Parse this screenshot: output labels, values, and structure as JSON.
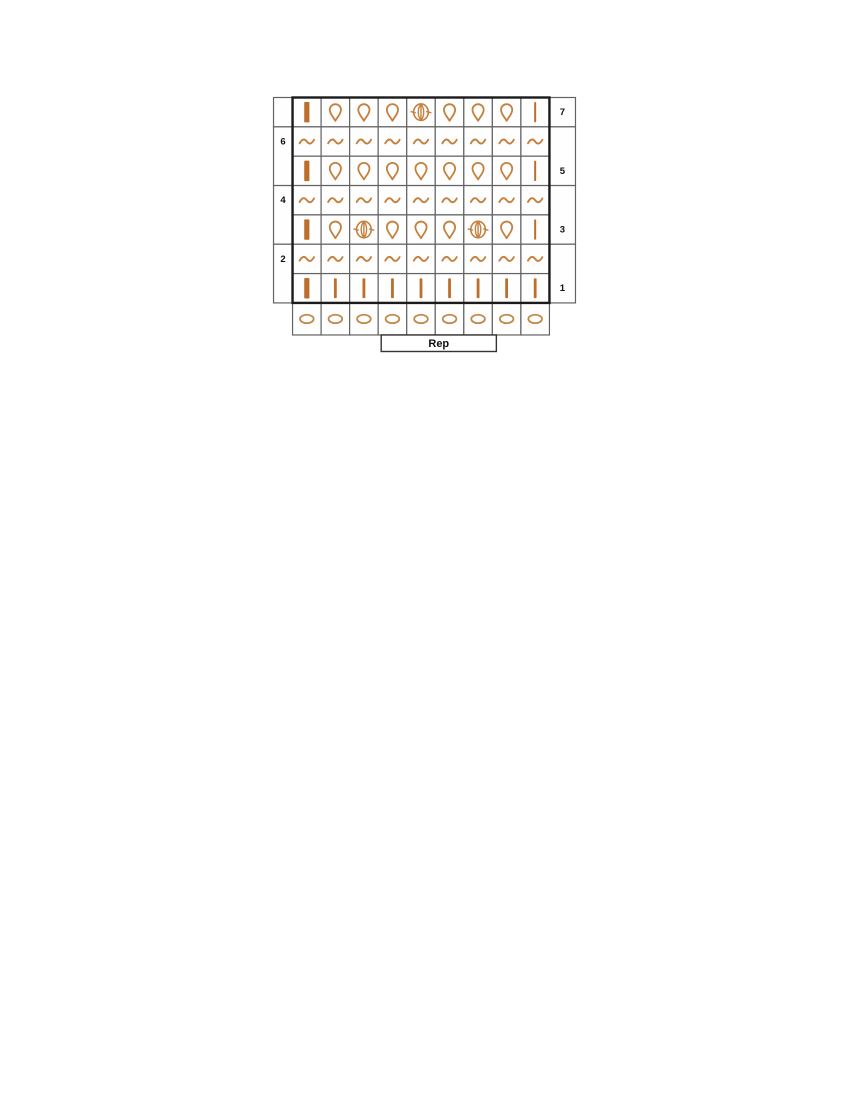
{
  "page": {
    "background_color": "#ffffff",
    "description": "crochet stitch chart"
  },
  "chart": {
    "type": "crochet-stitch-chart",
    "columns": 9,
    "rep_label": "Rep",
    "rep": {
      "start_col": 4,
      "end_col": 7
    },
    "colors": {
      "symbol_stroke": "#c6803e",
      "bar_fill": "#bd6e2b",
      "chain_stroke": "#c28a4a",
      "grid_line": "#636363",
      "outline": "#1b1b1b",
      "label_text": "#101010",
      "cell_fill": "#fefefe"
    },
    "rows": [
      {
        "label": "7",
        "side": "right",
        "cells": [
          "bar-thick",
          "drop",
          "drop",
          "drop",
          "bobble",
          "drop",
          "drop",
          "drop",
          "bar-thin"
        ]
      },
      {
        "label": "6",
        "side": "left",
        "cells": [
          "tilde",
          "tilde",
          "tilde",
          "tilde",
          "tilde",
          "tilde",
          "tilde",
          "tilde",
          "tilde"
        ]
      },
      {
        "label": "5",
        "side": "right",
        "cells": [
          "bar-thick",
          "drop",
          "drop",
          "drop",
          "drop",
          "drop",
          "drop",
          "drop",
          "bar-thin"
        ]
      },
      {
        "label": "4",
        "side": "left",
        "cells": [
          "tilde",
          "tilde",
          "tilde",
          "tilde",
          "tilde",
          "tilde",
          "tilde",
          "tilde",
          "tilde"
        ]
      },
      {
        "label": "3",
        "side": "right",
        "cells": [
          "bar-thick",
          "drop",
          "bobble",
          "drop",
          "drop",
          "drop",
          "bobble",
          "drop",
          "bar-thin"
        ]
      },
      {
        "label": "2",
        "side": "left",
        "cells": [
          "tilde",
          "tilde",
          "tilde",
          "tilde",
          "tilde",
          "tilde",
          "tilde",
          "tilde",
          "tilde"
        ]
      },
      {
        "label": "1",
        "side": "right",
        "cells": [
          "bar-thick",
          "bar-med",
          "bar-med",
          "bar-med",
          "bar-med",
          "bar-med",
          "bar-med",
          "bar-med",
          "bar-med"
        ]
      },
      {
        "label": "",
        "side": "none",
        "cells": [
          "chain",
          "chain",
          "chain",
          "chain",
          "chain",
          "chain",
          "chain",
          "chain",
          "chain"
        ]
      }
    ]
  }
}
